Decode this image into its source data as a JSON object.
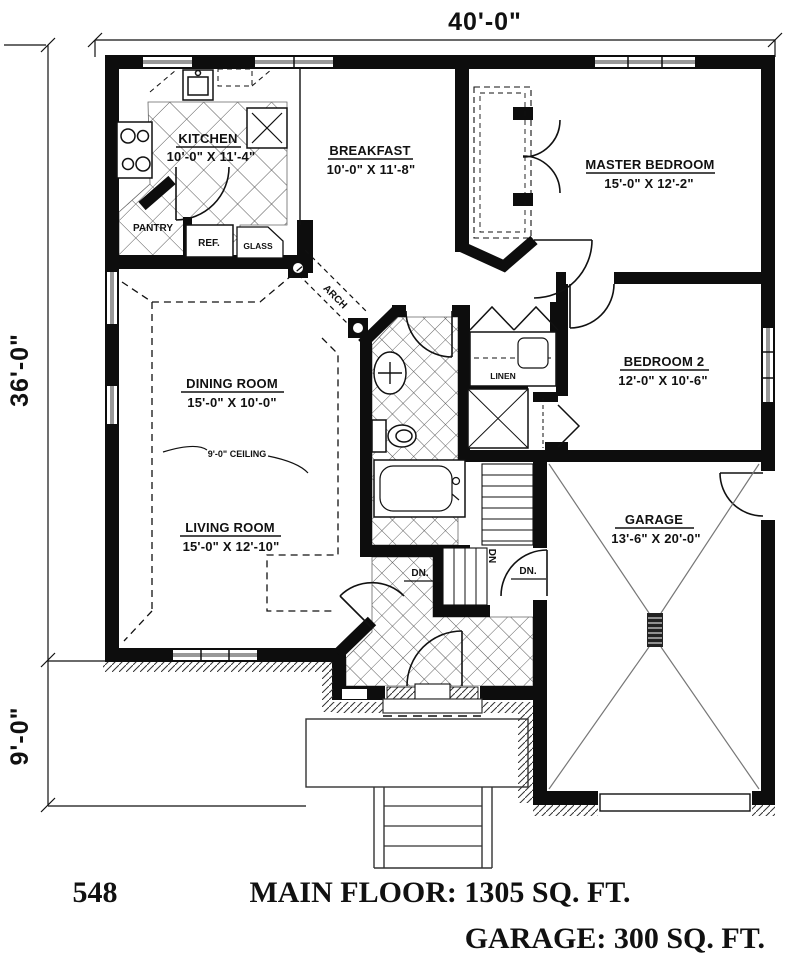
{
  "dimensions": {
    "width_top": "40'-0\"",
    "height_main": "36'-0\"",
    "height_porch": "9'-0\""
  },
  "rooms": {
    "kitchen": {
      "name": "KITCHEN",
      "size": "10'-0\" X 11'-4\""
    },
    "breakfast": {
      "name": "BREAKFAST",
      "size": "10'-0\" X 11'-8\""
    },
    "master_bedroom": {
      "name": "MASTER BEDROOM",
      "size": "15'-0\" X 12'-2\""
    },
    "bedroom_2": {
      "name": "BEDROOM 2",
      "size": "12'-0\" X 10'-6\""
    },
    "dining_room": {
      "name": "DINING ROOM",
      "size": "15'-0\" X 10'-0\""
    },
    "living_room": {
      "name": "LIVING ROOM",
      "size": "15'-0\" X 12'-10\""
    },
    "garage": {
      "name": "GARAGE",
      "size": "13'-6\" X 20'-0\""
    }
  },
  "labels": {
    "pantry": "PANTRY",
    "ref": "REF.",
    "glass": "GLASS",
    "arch": "ARCH",
    "linen": "LINEN",
    "ceiling_note": "9'-0\" CEILING",
    "down": "DN.",
    "down_short": "DN"
  },
  "footer": {
    "plan_number": "548",
    "main_floor": "MAIN FLOOR: 1305 SQ. FT.",
    "garage_area": "GARAGE: 300 SQ. FT."
  },
  "colors": {
    "ink": "#111111",
    "paper": "#ffffff",
    "window_gray": "#999999"
  }
}
